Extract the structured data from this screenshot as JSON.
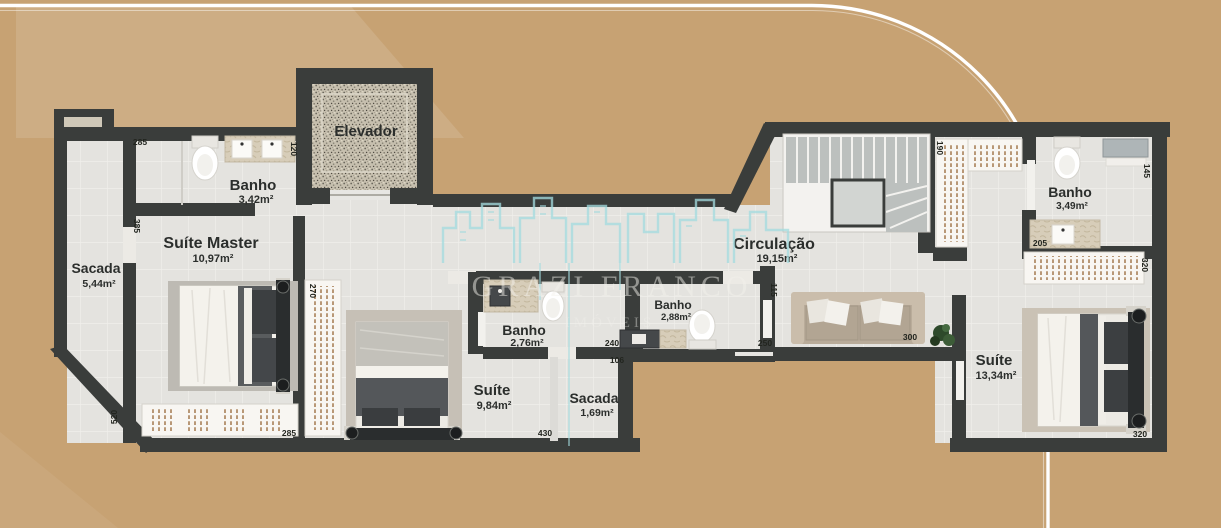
{
  "watermark": {
    "brand": "GRAZI FRANCO",
    "sub": "IMÓVEIS",
    "logo": "city-skyline",
    "logo_color": "#a5dce0"
  },
  "colors": {
    "background": "#c7a273",
    "wall": "#3a3d3b",
    "floor": "#e4e3df",
    "closet_tick": "#9c6f42",
    "border_line": "#ffffff"
  },
  "rooms": [
    {
      "name": "Sacada",
      "area": "5,44m²"
    },
    {
      "name": "Banho",
      "area": "3,42m²"
    },
    {
      "name": "Suíte Master",
      "area": "10,97m²"
    },
    {
      "name": "Elevador",
      "area": ""
    },
    {
      "name": "Banho",
      "area": "2,76m²"
    },
    {
      "name": "Suíte",
      "area": "9,84m²"
    },
    {
      "name": "Sacada",
      "area": "1,69m²"
    },
    {
      "name": "Banho",
      "area": "2,88m²"
    },
    {
      "name": "Circulação",
      "area": "19,15m²"
    },
    {
      "name": "Banho",
      "area": "3,49m²"
    },
    {
      "name": "Suíte",
      "area": "13,34m²"
    }
  ],
  "dimensions": [
    "285",
    "120",
    "385",
    "520",
    "270",
    "285",
    "430",
    "240",
    "106",
    "115",
    "250",
    "300",
    "190",
    "145",
    "205",
    "320",
    "320"
  ]
}
